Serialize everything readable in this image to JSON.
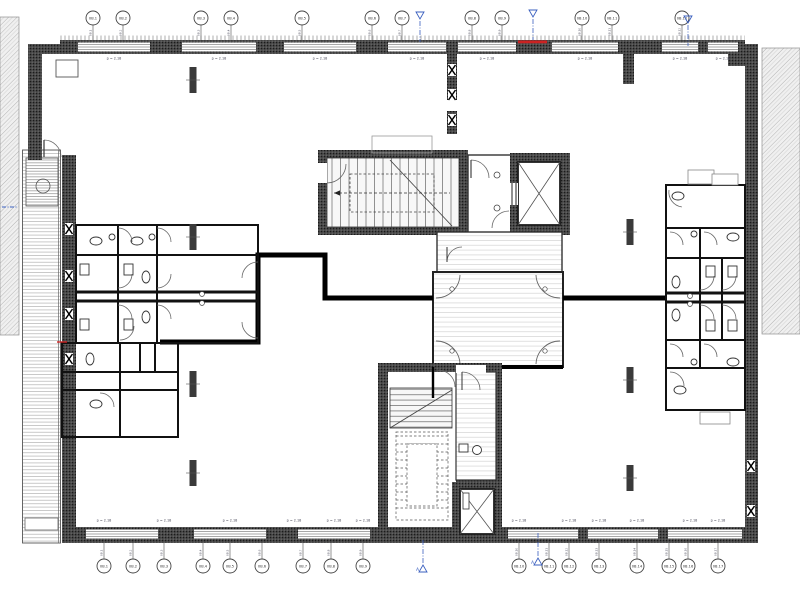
{
  "drawing": {
    "kind": "architectural-floor-plan",
    "floor_elements": [
      "stair-core-north",
      "stair-core-south",
      "elevator-north",
      "elevator-south",
      "wc-cluster-west",
      "wc-cluster-east",
      "open-office",
      "exterior-walkway-west"
    ]
  },
  "colors": {
    "wall_dark": "#3f3f3f",
    "line_black": "#111111",
    "accent_blue": "#3a5fbf",
    "accent_red": "#cc2222",
    "hatch_gray": "#a8a8a8",
    "floor_stripe": "#d8d8d8"
  },
  "dim_labels": {
    "text": "p = 2.18",
    "top": {
      "y": 59.5,
      "xs": [
        114,
        219,
        320,
        417,
        487,
        585,
        680,
        723
      ]
    },
    "bottom": {
      "y": 521.5,
      "xs": [
        104,
        164,
        230,
        294,
        334,
        363,
        519,
        569,
        599,
        637,
        690,
        718
      ]
    }
  },
  "grid_bubbles": {
    "top": [
      {
        "x": 93,
        "label": "0B.1"
      },
      {
        "x": 123,
        "label": "0B.2"
      },
      {
        "x": 201,
        "label": "0B.3"
      },
      {
        "x": 231,
        "label": "0B.4"
      },
      {
        "x": 302,
        "label": "0B.5"
      },
      {
        "x": 372,
        "label": "0B.6"
      },
      {
        "x": 402,
        "label": "0B.7"
      },
      {
        "x": 472,
        "label": "0B.8"
      },
      {
        "x": 502,
        "label": "0B.9"
      },
      {
        "x": 582,
        "label": "0B.10"
      },
      {
        "x": 612,
        "label": "0B.11"
      },
      {
        "x": 682,
        "label": "0B.12"
      }
    ],
    "bottom": [
      {
        "x": 104,
        "label": "0B.1"
      },
      {
        "x": 133,
        "label": "0B.2"
      },
      {
        "x": 164,
        "label": "0B.3"
      },
      {
        "x": 203,
        "label": "0B.4"
      },
      {
        "x": 230,
        "label": "0B.5"
      },
      {
        "x": 262,
        "label": "0B.6"
      },
      {
        "x": 303,
        "label": "0B.7"
      },
      {
        "x": 331,
        "label": "0B.8"
      },
      {
        "x": 363,
        "label": "0B.9"
      },
      {
        "x": 519,
        "label": "0B.10"
      },
      {
        "x": 549,
        "label": "0B.11"
      },
      {
        "x": 569,
        "label": "0B.12"
      },
      {
        "x": 599,
        "label": "0B.13"
      },
      {
        "x": 637,
        "label": "0B.14"
      },
      {
        "x": 669,
        "label": "0B.15"
      },
      {
        "x": 688,
        "label": "0B.16"
      },
      {
        "x": 718,
        "label": "0B.17"
      }
    ]
  },
  "section_markers": [
    {
      "x": 420,
      "y": 12,
      "dir": "down",
      "label": ""
    },
    {
      "x": 533,
      "y": 10,
      "dir": "down",
      "label": ""
    },
    {
      "x": 688,
      "y": 16,
      "dir": "down",
      "label": ""
    },
    {
      "x": 423,
      "y": 572,
      "dir": "up",
      "label": "A"
    },
    {
      "x": 538,
      "y": 565,
      "dir": "up",
      "label": "A"
    }
  ]
}
